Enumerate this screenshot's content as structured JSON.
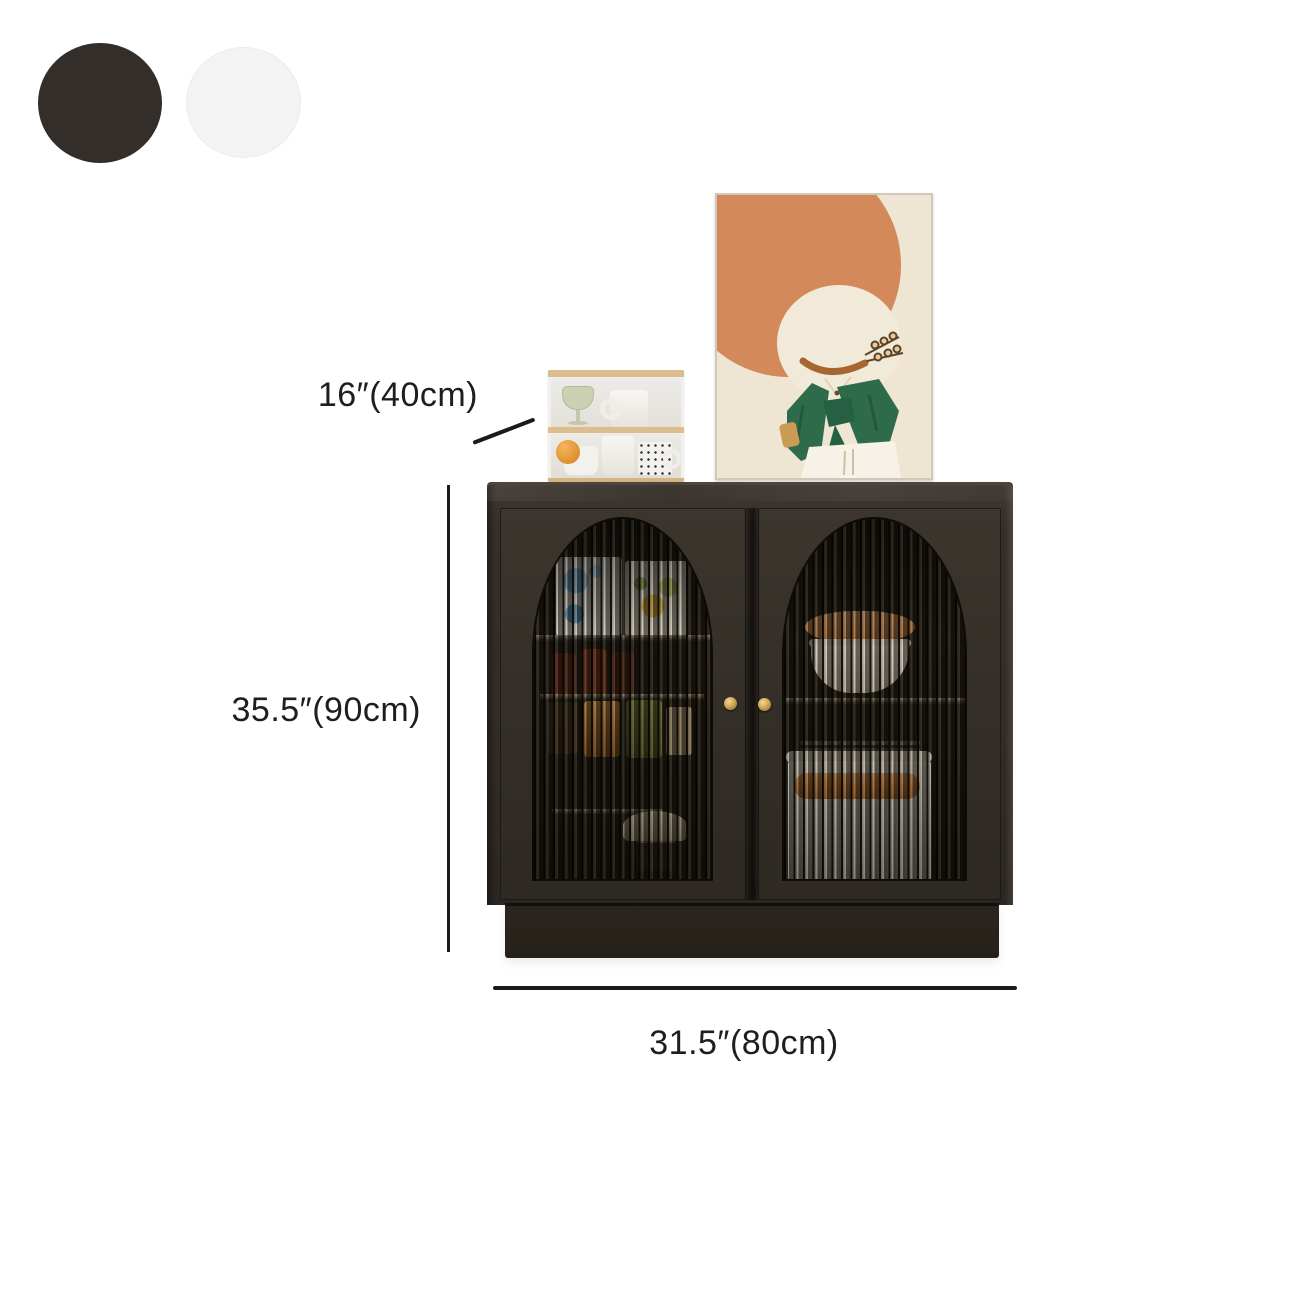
{
  "product_display": {
    "color_swatches": [
      {
        "name": "black",
        "hex": "#332e2a"
      },
      {
        "name": "white",
        "hex": "#f3f3f4"
      }
    ],
    "dimension_labels": {
      "top_shelf_depth": "16″(40cm)",
      "cabinet_height": "35.5″(90cm)",
      "cabinet_width": "31.5″(80cm)"
    },
    "palette": {
      "cabinet_body": "#322d27",
      "cabinet_plinth": "#282420",
      "door_knob_gold": "#c9a355",
      "fluted_glass": "#17130e",
      "wood_trim": "#dcbd8e",
      "dimension_line": "#1b1b1b",
      "artwork_orange": "#d3895a",
      "artwork_green": "#2e6b4a",
      "artwork_cream": "#efe5d3"
    }
  }
}
